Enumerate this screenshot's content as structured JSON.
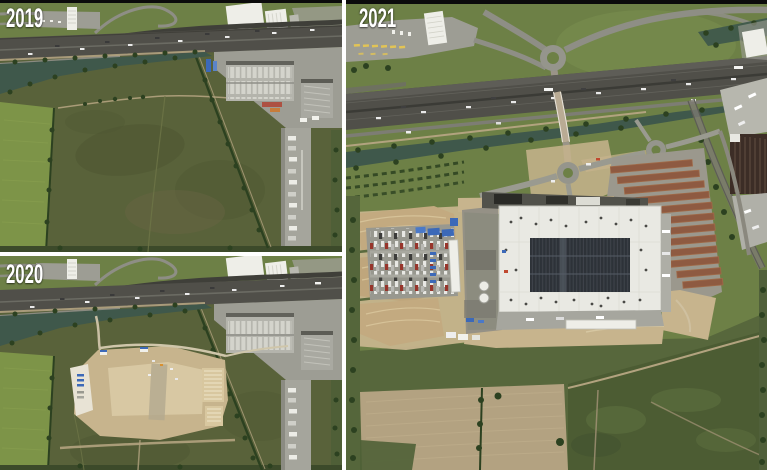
{
  "figure": {
    "panels": [
      {
        "label": "2019"
      },
      {
        "label": "2020"
      },
      {
        "label": "2021"
      }
    ]
  },
  "palette": {
    "black": "#0b0b0b",
    "divider": "#ffffff",
    "label": "#ffffff",
    "grass": "#6d8046",
    "grassbright": "#7d9448",
    "field": "#59623a",
    "fielddark": "#4b5531",
    "scrub": "#4c5c33",
    "tree": "#2c4120",
    "highway": "#504f49",
    "road": "#8e8e85",
    "yard": "#9d9d94",
    "concrete": "#b7b7ae",
    "building": "#eeeee8",
    "warehouse": "#b4b4ac",
    "water": "#3f584b",
    "dirt": "#c7b48d",
    "dirtlight": "#d9caa5",
    "dirtpale": "#e8e3d5",
    "sand": "#b3a281",
    "towpath": "#b2a37f",
    "solar": "#3e434a",
    "rust": "#8e5a41",
    "darkbuilding": "#3c2d26",
    "yellow": "#e2c455",
    "blue": "#3c69b8",
    "red": "#b04434"
  }
}
